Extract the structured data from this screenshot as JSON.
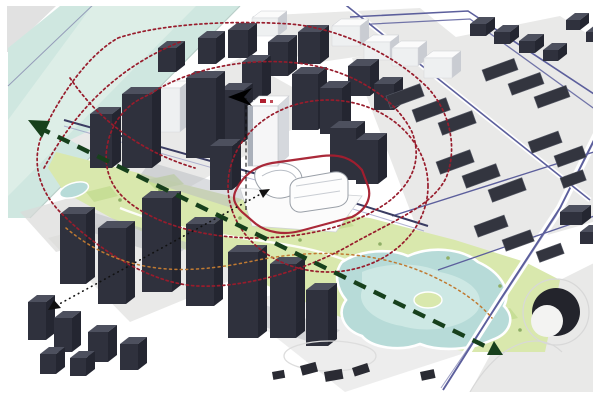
{
  "title": "Urban design axonometric massing diagram: white landmark tower and podium on a linear park, surrounded by dark context buildings, river at top-left, pond park at lower-right, red dotted view-influence contours, red site outline, blue road network, dark green dashed park axis arrow and black dotted sightlines",
  "canvas": {
    "width": 600,
    "height": 400
  },
  "colors": {
    "background": "#ffffff",
    "river": "#cfe7e0",
    "river_light": "#e1f0ea",
    "parcel": "#e9e9e8",
    "parcel_dark": "#dadad9",
    "building_top": "#4d505e",
    "building_front": "#2f313d",
    "building_side": "#242631",
    "building_white": "#eef0f1",
    "building_white_top": "#fbfbfb",
    "building_white_side": "#c9ccd2",
    "park": "#d9e8ad",
    "park_dark": "#c3dc92",
    "pond": "#b7dbd8",
    "pond_light": "#cde8e4",
    "road_blue": "#5c5f9c",
    "road_navy": "#3a3c62",
    "contour_red": "#981c2c",
    "contour_orange": "#c07a32",
    "axis_green": "#17401c",
    "sightline_black": "#111111",
    "site_outline_red": "#a51e2e",
    "landmark_accent_red": "#b02030"
  },
  "scene": {
    "buildings": [
      {
        "x": 122,
        "y": 94,
        "w": 30,
        "h": 74,
        "k": "d"
      },
      {
        "x": 90,
        "y": 114,
        "w": 22,
        "h": 54,
        "k": "d"
      },
      {
        "x": 160,
        "y": 88,
        "w": 20,
        "h": 44,
        "k": "w"
      },
      {
        "x": 186,
        "y": 78,
        "w": 30,
        "h": 80,
        "k": "d"
      },
      {
        "x": 220,
        "y": 90,
        "w": 24,
        "h": 52,
        "k": "d"
      },
      {
        "x": 242,
        "y": 62,
        "w": 20,
        "h": 38,
        "k": "d"
      },
      {
        "x": 292,
        "y": 74,
        "w": 26,
        "h": 56,
        "k": "d"
      },
      {
        "x": 320,
        "y": 88,
        "w": 22,
        "h": 46,
        "k": "d"
      },
      {
        "x": 330,
        "y": 128,
        "w": 26,
        "h": 52,
        "k": "d"
      },
      {
        "x": 356,
        "y": 140,
        "w": 22,
        "h": 44,
        "k": "d"
      },
      {
        "x": 210,
        "y": 146,
        "w": 22,
        "h": 44,
        "k": "d"
      },
      {
        "x": 268,
        "y": 42,
        "w": 20,
        "h": 34,
        "k": "d"
      },
      {
        "x": 298,
        "y": 32,
        "w": 22,
        "h": 32,
        "k": "d"
      },
      {
        "x": 228,
        "y": 30,
        "w": 20,
        "h": 28,
        "k": "d"
      },
      {
        "x": 198,
        "y": 38,
        "w": 18,
        "h": 26,
        "k": "d"
      },
      {
        "x": 158,
        "y": 48,
        "w": 18,
        "h": 24,
        "k": "d"
      },
      {
        "x": 252,
        "y": 18,
        "w": 26,
        "h": 18,
        "k": "w"
      },
      {
        "x": 332,
        "y": 26,
        "w": 28,
        "h": 20,
        "k": "w"
      },
      {
        "x": 364,
        "y": 42,
        "w": 26,
        "h": 18,
        "k": "w"
      },
      {
        "x": 392,
        "y": 48,
        "w": 26,
        "h": 18,
        "k": "w"
      },
      {
        "x": 424,
        "y": 58,
        "w": 28,
        "h": 20,
        "k": "w"
      },
      {
        "x": 348,
        "y": 66,
        "w": 22,
        "h": 30,
        "k": "d"
      },
      {
        "x": 374,
        "y": 84,
        "w": 20,
        "h": 26,
        "k": "d"
      },
      {
        "x": 222,
        "y": 120,
        "w": 38,
        "h": 14,
        "k": "d"
      },
      {
        "x": 60,
        "y": 214,
        "w": 26,
        "h": 70,
        "k": "d"
      },
      {
        "x": 98,
        "y": 228,
        "w": 28,
        "h": 76,
        "k": "d"
      },
      {
        "x": 142,
        "y": 198,
        "w": 30,
        "h": 94,
        "k": "d"
      },
      {
        "x": 186,
        "y": 224,
        "w": 28,
        "h": 82,
        "k": "d"
      },
      {
        "x": 228,
        "y": 252,
        "w": 30,
        "h": 86,
        "k": "d"
      },
      {
        "x": 270,
        "y": 264,
        "w": 26,
        "h": 74,
        "k": "d"
      },
      {
        "x": 306,
        "y": 290,
        "w": 22,
        "h": 56,
        "k": "d"
      },
      {
        "x": 28,
        "y": 302,
        "w": 18,
        "h": 38,
        "k": "d"
      },
      {
        "x": 54,
        "y": 318,
        "w": 18,
        "h": 34,
        "k": "d"
      },
      {
        "x": 88,
        "y": 332,
        "w": 20,
        "h": 30,
        "k": "d"
      },
      {
        "x": 120,
        "y": 344,
        "w": 18,
        "h": 26,
        "k": "d"
      },
      {
        "x": 40,
        "y": 354,
        "w": 16,
        "h": 20,
        "k": "d"
      },
      {
        "x": 70,
        "y": 358,
        "w": 16,
        "h": 18,
        "k": "d"
      },
      {
        "x": 470,
        "y": 24,
        "w": 16,
        "h": 12,
        "k": "d"
      },
      {
        "x": 494,
        "y": 32,
        "w": 16,
        "h": 12,
        "k": "d"
      },
      {
        "x": 519,
        "y": 41,
        "w": 16,
        "h": 12,
        "k": "d"
      },
      {
        "x": 543,
        "y": 50,
        "w": 15,
        "h": 11,
        "k": "d"
      },
      {
        "x": 566,
        "y": 20,
        "w": 14,
        "h": 10,
        "k": "d"
      },
      {
        "x": 586,
        "y": 32,
        "w": 12,
        "h": 10,
        "k": "d"
      },
      {
        "x": 560,
        "y": 212,
        "w": 22,
        "h": 13,
        "k": "d"
      },
      {
        "x": 580,
        "y": 232,
        "w": 18,
        "h": 12,
        "k": "d"
      }
    ],
    "slabs": [
      {
        "x": 386,
        "y": 96,
        "w": 36,
        "h": 13,
        "a": -20
      },
      {
        "x": 412,
        "y": 110,
        "w": 36,
        "h": 13,
        "a": -20
      },
      {
        "x": 438,
        "y": 123,
        "w": 36,
        "h": 13,
        "a": -20
      },
      {
        "x": 482,
        "y": 70,
        "w": 34,
        "h": 12,
        "a": -20
      },
      {
        "x": 508,
        "y": 84,
        "w": 34,
        "h": 12,
        "a": -20
      },
      {
        "x": 534,
        "y": 97,
        "w": 34,
        "h": 12,
        "a": -20
      },
      {
        "x": 436,
        "y": 162,
        "w": 36,
        "h": 13,
        "a": -20
      },
      {
        "x": 462,
        "y": 176,
        "w": 36,
        "h": 13,
        "a": -20
      },
      {
        "x": 488,
        "y": 190,
        "w": 36,
        "h": 13,
        "a": -20
      },
      {
        "x": 528,
        "y": 142,
        "w": 32,
        "h": 12,
        "a": -20
      },
      {
        "x": 554,
        "y": 156,
        "w": 30,
        "h": 12,
        "a": -20
      },
      {
        "x": 474,
        "y": 226,
        "w": 32,
        "h": 12,
        "a": -20
      },
      {
        "x": 502,
        "y": 240,
        "w": 30,
        "h": 12,
        "a": -20
      },
      {
        "x": 536,
        "y": 252,
        "w": 26,
        "h": 11,
        "a": -20
      },
      {
        "x": 560,
        "y": 178,
        "w": 24,
        "h": 11,
        "a": -20
      }
    ],
    "sculptures": [
      {
        "x": 300,
        "y": 366,
        "w": 16,
        "h": 10,
        "a": -15
      },
      {
        "x": 324,
        "y": 372,
        "w": 18,
        "h": 10,
        "a": -10
      },
      {
        "x": 352,
        "y": 368,
        "w": 16,
        "h": 9,
        "a": -18
      },
      {
        "x": 420,
        "y": 372,
        "w": 14,
        "h": 9,
        "a": -12
      },
      {
        "x": 272,
        "y": 372,
        "w": 12,
        "h": 8,
        "a": -10
      }
    ]
  },
  "annotations": {
    "site_outline": "red rounded boundary around landmark podium",
    "contours": "red dotted irregular influence loops and dashed circle",
    "axis": "dark green dashed double-headed arrow along linear park",
    "sightline": "black dotted arrow from south-west towards site",
    "tower_marker": "red roof vent on white landmark tower",
    "direction_icon": "small black dart above tower with vertical dashed line"
  }
}
